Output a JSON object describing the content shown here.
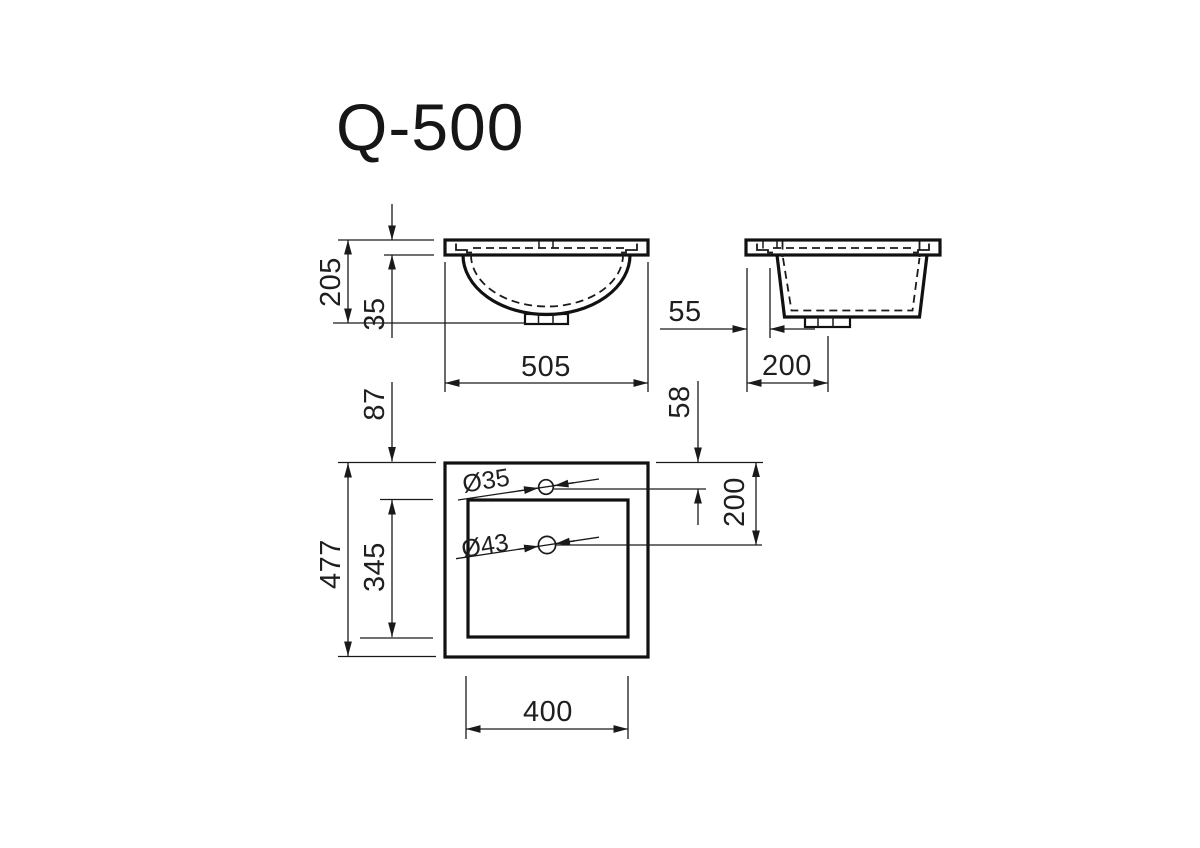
{
  "title": "Q-500",
  "colors": {
    "line_color": "#1a1a1a",
    "background": "#ffffff"
  },
  "views": {
    "front": {
      "overall_height": "205",
      "rim_height": "35",
      "overall_width": "505"
    },
    "side": {
      "back_edge_to_basin": "55",
      "back_edge_to_drain": "200"
    },
    "plan": {
      "back_edge_to_cutout": "87",
      "overall_depth": "477",
      "cutout_depth": "345",
      "cutout_width": "400",
      "faucet_hole_offset": "58",
      "drain_hole_offset": "200",
      "faucet_hole_diameter": "Ø35",
      "drain_hole_diameter": "Ø43"
    }
  }
}
